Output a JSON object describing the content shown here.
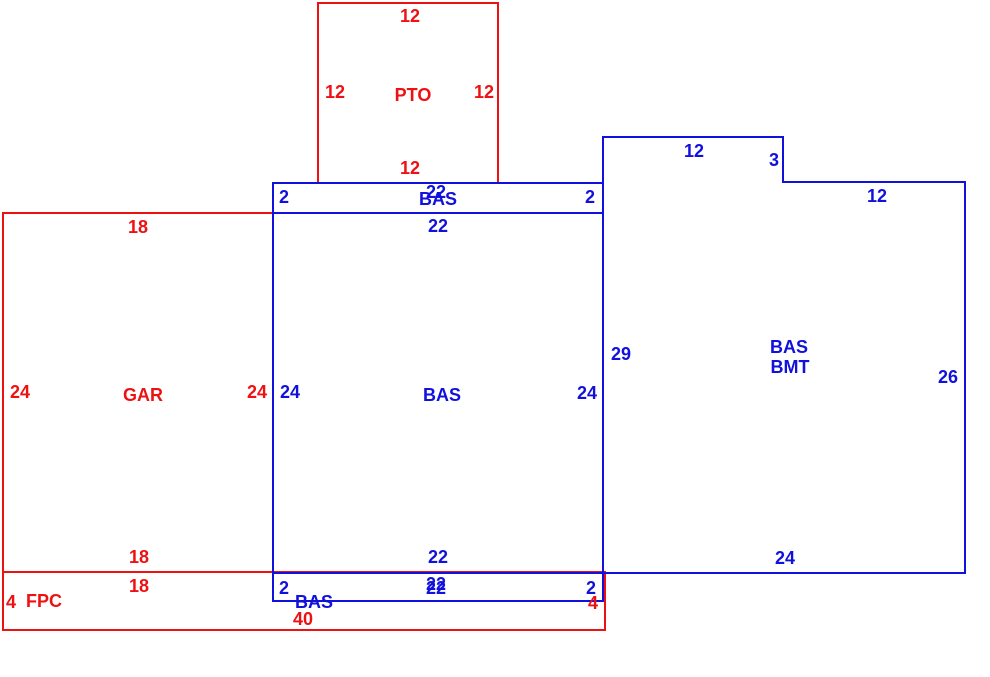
{
  "diagram": {
    "type": "floor-plan-sketch",
    "colors": {
      "red": "#ee1111",
      "blue": "#1111dd",
      "background": "#ffffff"
    },
    "areas": [
      {
        "code": "PTO",
        "color": "red"
      },
      {
        "code": "GAR",
        "color": "red"
      },
      {
        "code": "FPC",
        "color": "red"
      },
      {
        "code": "BAS",
        "color": "blue"
      },
      {
        "code": "BAS BMT",
        "color": "blue"
      }
    ],
    "labels": [
      {
        "name": "dim-pto-top-12",
        "text": "12",
        "color": "red",
        "x": 410,
        "y": 16
      },
      {
        "name": "dim-pto-left-12",
        "text": "12",
        "color": "red",
        "x": 335,
        "y": 92
      },
      {
        "name": "area-pto-label",
        "text": "PTO",
        "color": "red",
        "x": 413,
        "y": 95
      },
      {
        "name": "dim-pto-right-12",
        "text": "12",
        "color": "red",
        "x": 484,
        "y": 92
      },
      {
        "name": "dim-pto-bottom-12",
        "text": "12",
        "color": "red",
        "x": 410,
        "y": 168
      },
      {
        "name": "dim-gar-top-18",
        "text": "18",
        "color": "red",
        "x": 138,
        "y": 227
      },
      {
        "name": "dim-gar-left-24",
        "text": "24",
        "color": "red",
        "x": 20,
        "y": 392
      },
      {
        "name": "area-gar-label",
        "text": "GAR",
        "color": "red",
        "x": 143,
        "y": 395
      },
      {
        "name": "dim-gar-right-24",
        "text": "24",
        "color": "red",
        "x": 257,
        "y": 392
      },
      {
        "name": "dim-gar-bottom-18",
        "text": "18",
        "color": "red",
        "x": 139,
        "y": 557
      },
      {
        "name": "dim-fpc-top-18",
        "text": "18",
        "color": "red",
        "x": 139,
        "y": 586
      },
      {
        "name": "dim-fpc-left-4",
        "text": "4",
        "color": "red",
        "x": 11,
        "y": 602
      },
      {
        "name": "area-fpc-label",
        "text": "FPC",
        "color": "red",
        "x": 44,
        "y": 601
      },
      {
        "name": "dim-fpc-bottom-40",
        "text": "40",
        "color": "red",
        "x": 303,
        "y": 619
      },
      {
        "name": "dim-fpc-right-4",
        "text": "4",
        "color": "red",
        "x": 593,
        "y": 603
      },
      {
        "name": "dim-strip-top-left-2",
        "text": "2",
        "color": "blue",
        "x": 284,
        "y": 197
      },
      {
        "name": "dim-strip-top-22",
        "text": "22",
        "color": "blue",
        "x": 436,
        "y": 192
      },
      {
        "name": "area-strip-top-bas",
        "text": "BAS",
        "color": "blue",
        "x": 438,
        "y": 199
      },
      {
        "name": "dim-strip-top-right-2",
        "text": "2",
        "color": "blue",
        "x": 590,
        "y": 197
      },
      {
        "name": "dim-bas-top-22",
        "text": "22",
        "color": "blue",
        "x": 438,
        "y": 226
      },
      {
        "name": "dim-bas-left-24",
        "text": "24",
        "color": "blue",
        "x": 290,
        "y": 392
      },
      {
        "name": "area-bas-label",
        "text": "BAS",
        "color": "blue",
        "x": 442,
        "y": 395
      },
      {
        "name": "dim-bas-right-24",
        "text": "24",
        "color": "blue",
        "x": 587,
        "y": 393
      },
      {
        "name": "dim-bas-bottom-22",
        "text": "22",
        "color": "blue",
        "x": 438,
        "y": 557
      },
      {
        "name": "dim-strip-bottom-22a",
        "text": "22",
        "color": "blue",
        "x": 436,
        "y": 584
      },
      {
        "name": "dim-strip-bottom-22b",
        "text": "22",
        "color": "blue",
        "x": 436,
        "y": 588
      },
      {
        "name": "dim-strip-bottom-left-2",
        "text": "2",
        "color": "blue",
        "x": 284,
        "y": 588
      },
      {
        "name": "dim-strip-bottom-right-2",
        "text": "2",
        "color": "blue",
        "x": 591,
        "y": 588
      },
      {
        "name": "area-strip-bottom-bas",
        "text": "BAS",
        "color": "blue",
        "x": 314,
        "y": 602
      },
      {
        "name": "dim-bmt-top-12",
        "text": "12",
        "color": "blue",
        "x": 694,
        "y": 151
      },
      {
        "name": "dim-bmt-step-3",
        "text": "3",
        "color": "blue",
        "x": 774,
        "y": 160
      },
      {
        "name": "dim-bmt-top2-12",
        "text": "12",
        "color": "blue",
        "x": 877,
        "y": 196
      },
      {
        "name": "dim-bmt-left-29",
        "text": "29",
        "color": "blue",
        "x": 621,
        "y": 354
      },
      {
        "name": "area-bmt-bas-label",
        "text": "BAS",
        "color": "blue",
        "x": 789,
        "y": 347
      },
      {
        "name": "area-bmt-bmt-label",
        "text": "BMT",
        "color": "blue",
        "x": 790,
        "y": 367
      },
      {
        "name": "dim-bmt-right-26",
        "text": "26",
        "color": "blue",
        "x": 948,
        "y": 377
      },
      {
        "name": "dim-bmt-bottom-24",
        "text": "24",
        "color": "blue",
        "x": 785,
        "y": 558
      }
    ]
  }
}
